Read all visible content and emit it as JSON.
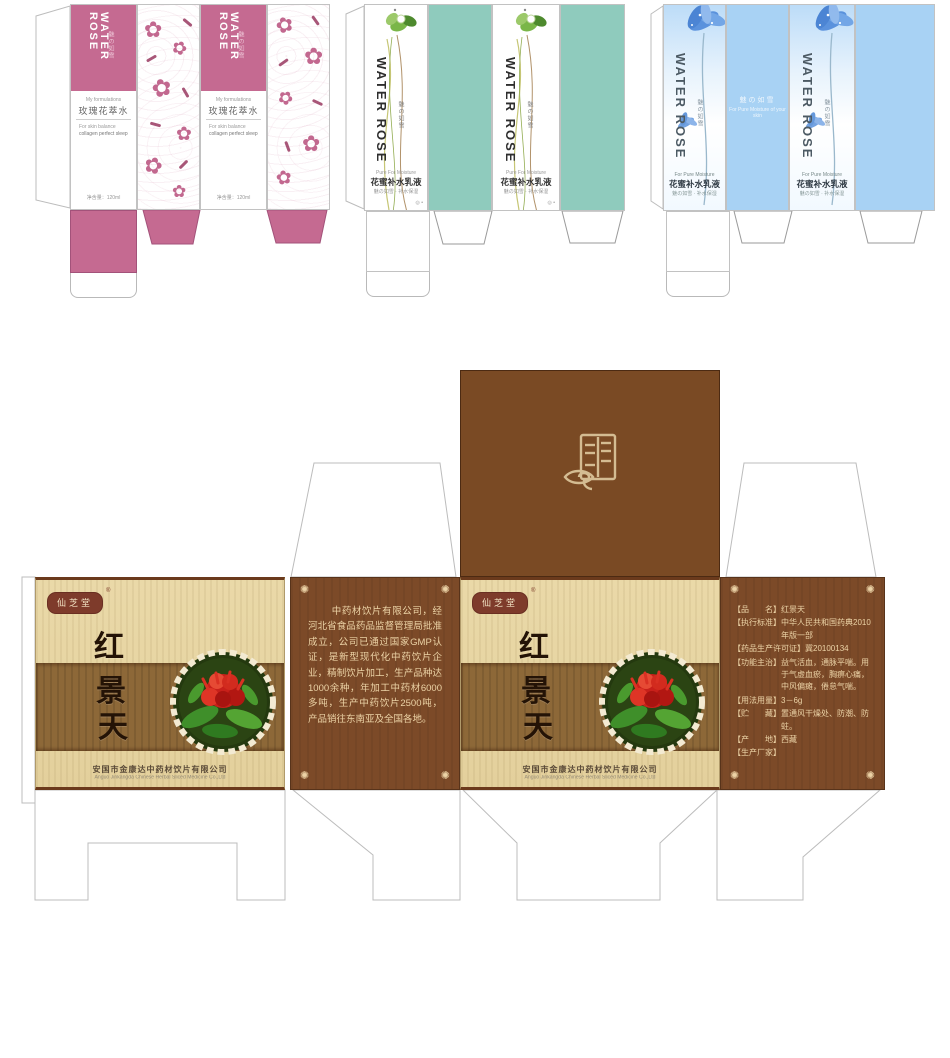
{
  "icons": {
    "rose": "✿",
    "ornament": "✺",
    "dot_mark": "◎ •",
    "flower_dot": "•"
  },
  "cosmetic_boxes": {
    "brand": "WATER ROSE",
    "brand_sub": "魅の如雪",
    "pink": {
      "tagline": "My formulations",
      "product_name": "玫瑰花萃水",
      "desc_line1": "For skin balance",
      "desc_line2": "collagen perfect sleep",
      "bottom_note": "净含量：120ml",
      "header_color": "#c56a91"
    },
    "green": {
      "tagline": "Pure For Moisture",
      "product_name": "花蜜补水乳液",
      "sub_note": "魅の如雪 · 补水保湿",
      "panel_color": "#8fcbbd"
    },
    "blue": {
      "tagline": "For Pure Moisture",
      "product_name": "花蜜补水乳液",
      "sub_note": "魅の如雪 · 补水保湿",
      "watermark_line1": "魅の如雪",
      "watermark_line2": "For Pure Moisture of your skin",
      "panel_color": "#a8d2f4"
    }
  },
  "herb_box": {
    "brand_seal": "仙芝堂",
    "reg_mark": "®",
    "title_char1": "红",
    "title_char2": "景",
    "title_char3": "天",
    "company_cn": "安国市金康达中药材饮片有限公司",
    "company_en": "Anguo Jinkangda Chinese Herbal Sliced Medicine Co.,Ltd",
    "intro_text": "中药材饮片有限公司，经河北省食品药品监督管理局批准成立，公司已通过国家GMP认证，是新型现代化中药饮片企业，精制饮片加工，生产品种达1000余种，年加工中药材6000多吨，生产中药饮片2500吨，产品销往东南亚及全国各地。",
    "info": [
      {
        "label": "【品　　名】",
        "value": "红景天"
      },
      {
        "label": "【执行标准】",
        "value": "中华人民共和国药典2010年版一部"
      },
      {
        "label": "【药品生产许可证】",
        "value": "冀20100134"
      },
      {
        "label": "【功能主治】",
        "value": "益气活血，通脉平喘。用于气虚血瘀，胸痹心痛，中风偏瘫，倦怠气喘。"
      },
      {
        "label": "【用法用量】",
        "value": "3－6g"
      },
      {
        "label": "【贮　　藏】",
        "value": "置通风干燥处、防潮、防蛀。"
      },
      {
        "label": "【产　　地】",
        "value": "西藏"
      },
      {
        "label": "【生产厂家】",
        "value": ""
      }
    ],
    "colors": {
      "flap_brown": "#7a4a24",
      "side_brown": "#7c4a28",
      "front_tan": "#e7d6a4",
      "band_brown": "#8d6838",
      "text_tan": "#ecd3a6"
    }
  }
}
